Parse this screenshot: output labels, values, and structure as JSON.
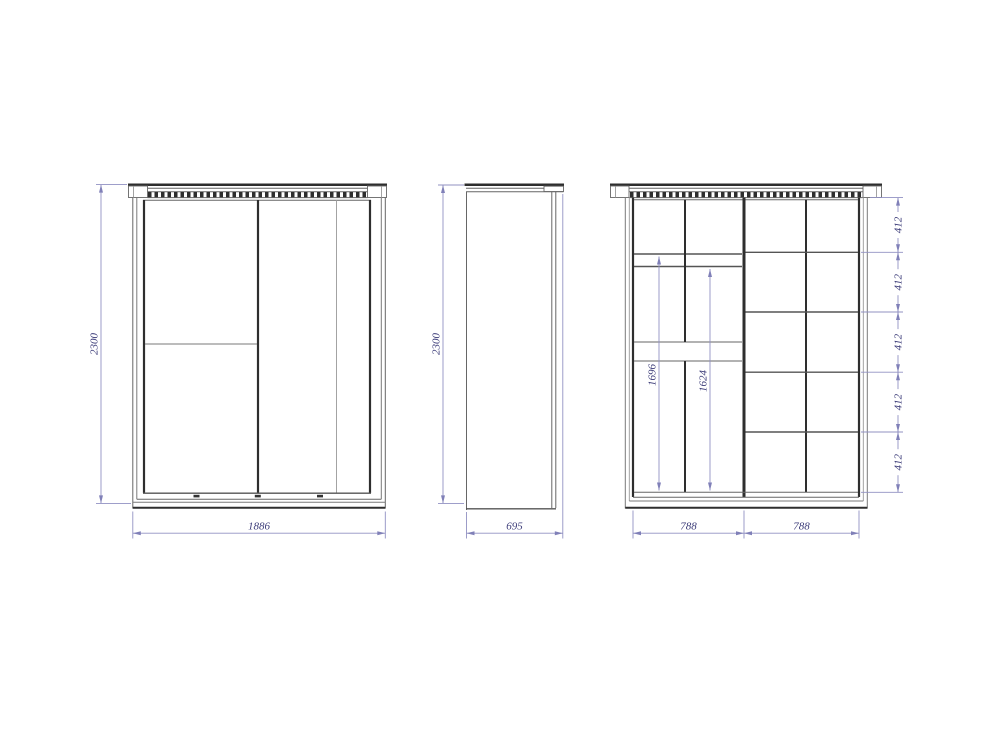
{
  "colors": {
    "background": "#ffffff",
    "outline": "#2e2e2e",
    "dimension_line": "#9191c2",
    "dimension_text": "#3b3b78"
  },
  "views": {
    "front": {
      "height": "2300",
      "width": "1886"
    },
    "side": {
      "height": "2300",
      "depth": "695"
    },
    "interior": {
      "left_section_height_1": "1696",
      "left_section_height_2": "1624",
      "section_width_left": "788",
      "section_width_right": "788",
      "shelf_spacings": [
        "412",
        "412",
        "412",
        "412",
        "412"
      ]
    }
  }
}
